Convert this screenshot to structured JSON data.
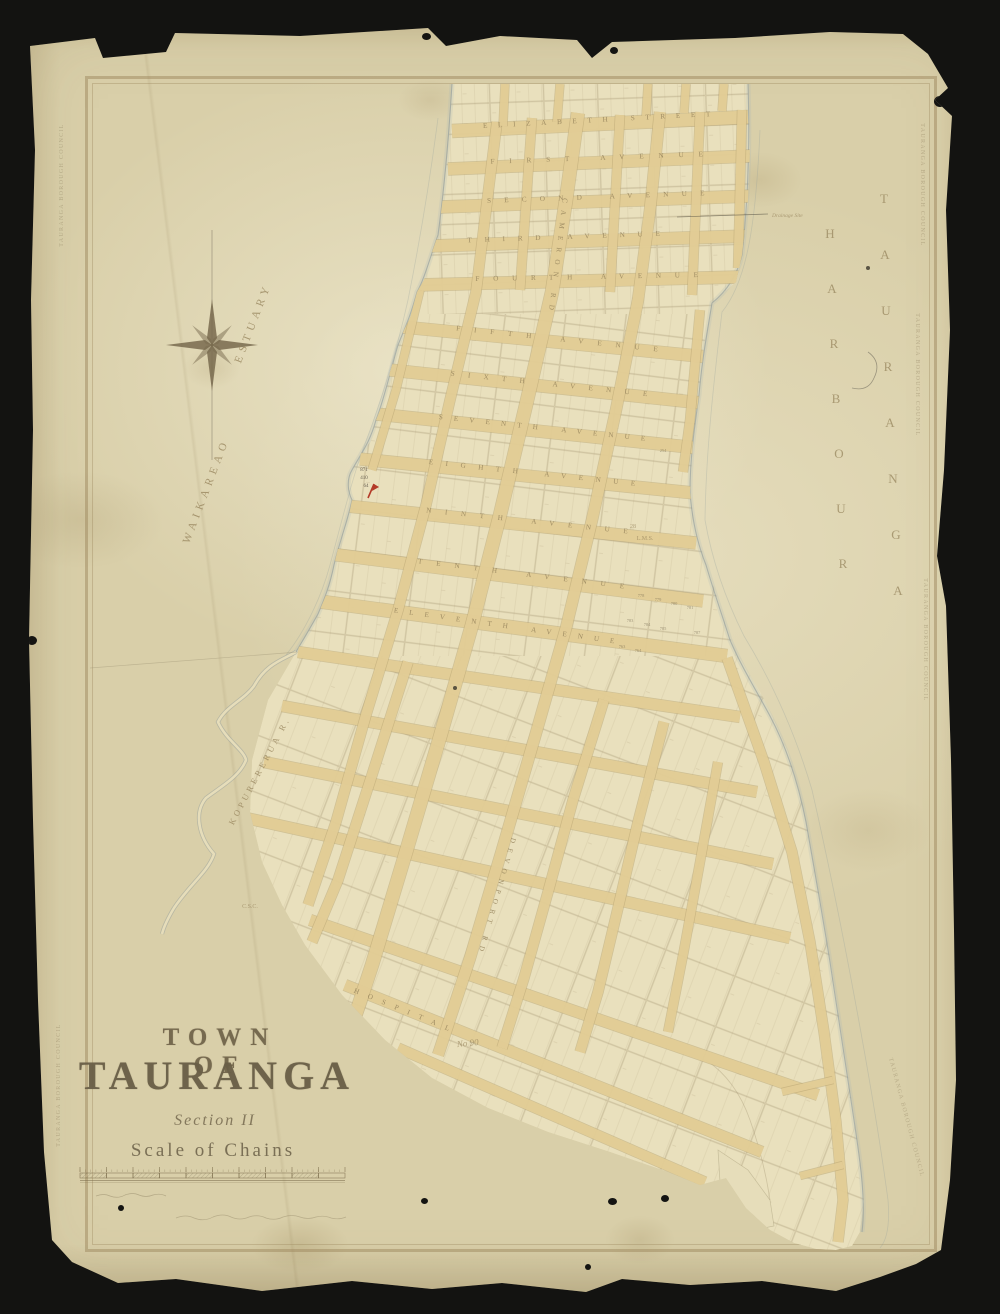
{
  "colors": {
    "backdrop": "#131311",
    "paper": "#e6ddba",
    "block_fill": "#e9e0bd",
    "street_fill": "#e3cd96",
    "street_edge": "#b39f6e",
    "parcel_line": "#93815c",
    "label_ink": "#97855d",
    "title_ink": "#6e6249",
    "shoreline": "#8d999b",
    "water_wash": "#a9b6b4",
    "red_mark": "#b33a28",
    "stamp_ink": "#7d6c4e",
    "pencil": "#6f675a"
  },
  "title_block": {
    "town_of": "TOWN OF",
    "name": "TAURANGA",
    "section": "Section II",
    "scale": "Scale of Chains"
  },
  "stamp": {
    "text": "TAURANGA BOROUGH COUNCIL",
    "positions": [
      {
        "x": 63,
        "y": 185,
        "r": -90
      },
      {
        "x": 60,
        "y": 1085,
        "r": -90
      },
      {
        "x": 921,
        "y": 185,
        "r": 90
      },
      {
        "x": 916,
        "y": 375,
        "r": 90
      },
      {
        "x": 924,
        "y": 640,
        "r": 90
      },
      {
        "x": 905,
        "y": 1118,
        "r": 75
      }
    ]
  },
  "map": {
    "water_labels": {
      "estuary_w1": {
        "t": "WAIKAREAO",
        "x": 209,
        "y": 492,
        "r": -69
      },
      "estuary_w2": {
        "t": "ESTUARY",
        "x": 256,
        "y": 324,
        "r": -69
      },
      "river": {
        "t": "KOPURERERUA R.",
        "x": 262,
        "y": 772,
        "r": -62
      },
      "harbour_w1": {
        "t": "TAURANGA",
        "x": 884,
        "y0": 203,
        "dy": 56,
        "dx": [
          0,
          1,
          2,
          4,
          6,
          9,
          12,
          14
        ]
      },
      "harbour_w2": {
        "t": "HARBOUR",
        "x": 830,
        "y0": 238,
        "dy": 55,
        "dx": [
          0,
          2,
          4,
          6,
          9,
          11,
          13
        ]
      }
    },
    "annotations": [
      {
        "t": "Drainage Site",
        "x": 772,
        "y": 217,
        "s": 5.5,
        "r": 0,
        "script": true,
        "anchor": "start"
      },
      {
        "t": "L.M.S.",
        "x": 645,
        "y": 540,
        "s": 6,
        "r": 0
      },
      {
        "t": "28",
        "x": 633,
        "y": 528,
        "s": 6,
        "r": 0
      },
      {
        "t": "C.S.C.",
        "x": 250,
        "y": 908,
        "s": 6,
        "r": 0
      },
      {
        "t": "No 90",
        "x": 468,
        "y": 1046,
        "s": 9,
        "r": -6,
        "script": true
      },
      {
        "t": "871",
        "x": 364,
        "y": 471,
        "s": 5,
        "r": 0,
        "dark": true
      },
      {
        "t": "410",
        "x": 364,
        "y": 479,
        "s": 5,
        "r": 0,
        "dark": true
      },
      {
        "t": "64",
        "x": 366,
        "y": 487,
        "s": 5,
        "r": 0,
        "dark": true
      }
    ],
    "lot_numbers": [
      [
        "254",
        663,
        452
      ],
      [
        "778",
        641,
        597
      ],
      [
        "779",
        658,
        601
      ],
      [
        "780",
        674,
        605
      ],
      [
        "781",
        690,
        609
      ],
      [
        "783",
        630,
        622
      ],
      [
        "784",
        647,
        626
      ],
      [
        "785",
        663,
        630
      ],
      [
        "787",
        697,
        634
      ],
      [
        "763",
        622,
        648
      ],
      [
        "764",
        638,
        652
      ]
    ],
    "streets": [
      {
        "n": "elizabeth-street",
        "label": "ELIZABETH STREET",
        "pts": [
          [
            452,
            131
          ],
          [
            748,
            117
          ]
        ],
        "w": 13,
        "lp": [
          598,
          122
        ],
        "lr": -3,
        "ll": 230
      },
      {
        "n": "first-avenue",
        "label": "FIRST AVENUE",
        "pts": [
          [
            448,
            169
          ],
          [
            750,
            156
          ]
        ],
        "w": 12,
        "lp": [
          598,
          160
        ],
        "lr": -2,
        "ll": 215
      },
      {
        "n": "second-avenue",
        "label": "SECOND AVENUE",
        "pts": [
          [
            440,
            207
          ],
          [
            752,
            196
          ]
        ],
        "w": 12,
        "lp": [
          597,
          199
        ],
        "lr": -2,
        "ll": 220
      },
      {
        "n": "third-avenue",
        "label": "THIRD AVENUE",
        "pts": [
          [
            430,
            246
          ],
          [
            748,
            236
          ]
        ],
        "w": 12,
        "lp": [
          565,
          239
        ],
        "lr": -2,
        "ll": 195
      },
      {
        "n": "fourth-avenue",
        "label": "FOURTH AVENUE",
        "pts": [
          [
            417,
            285
          ],
          [
            740,
            277
          ]
        ],
        "w": 12,
        "lp": [
          588,
          279
        ],
        "lr": -1,
        "ll": 225
      },
      {
        "n": "fifth-avenue",
        "label": "FIFTH AVENUE",
        "pts": [
          [
            403,
            327
          ],
          [
            708,
            357
          ]
        ],
        "w": 12,
        "lp": [
          558,
          341
        ],
        "lr": 6,
        "ll": 205
      },
      {
        "n": "sixth-avenue",
        "label": "SIXTH AVENUE",
        "pts": [
          [
            390,
            370
          ],
          [
            702,
            403
          ]
        ],
        "w": 12,
        "lp": [
          550,
          386
        ],
        "lr": 6,
        "ll": 200
      },
      {
        "n": "seventh-avenue",
        "label": "SEVENTH AVENUE",
        "pts": [
          [
            376,
            414
          ],
          [
            698,
            448
          ]
        ],
        "w": 12,
        "lp": [
          543,
          430
        ],
        "lr": 6,
        "ll": 210
      },
      {
        "n": "eighth-avenue",
        "label": "EIGHTH AVENUE",
        "pts": [
          [
            360,
            459
          ],
          [
            694,
            493
          ]
        ],
        "w": 12,
        "lp": [
          533,
          475
        ],
        "lr": 6,
        "ll": 210
      },
      {
        "n": "ninth-avenue",
        "label": "NINTH AVENUE",
        "pts": [
          [
            347,
            506
          ],
          [
            696,
            543
          ]
        ],
        "w": 12,
        "lp": [
          528,
          523
        ],
        "lr": 6,
        "ll": 205
      },
      {
        "n": "tenth-avenue",
        "label": "TENTH AVENUE",
        "pts": [
          [
            330,
            554
          ],
          [
            703,
            601
          ]
        ],
        "w": 12,
        "lp": [
          522,
          576
        ],
        "lr": 7,
        "ll": 210
      },
      {
        "n": "eleventh-avenue",
        "label": "ELEVENTH AVENUE",
        "pts": [
          [
            316,
            601
          ],
          [
            727,
            656
          ]
        ],
        "w": 13,
        "lp": [
          505,
          628
        ],
        "lr": 8,
        "ll": 225
      },
      {
        "n": "twelfth-avenue",
        "label": "",
        "pts": [
          [
            298,
            652
          ],
          [
            740,
            717
          ]
        ],
        "w": 11
      },
      {
        "n": "thirteenth-avenue",
        "label": "",
        "pts": [
          [
            282,
            706
          ],
          [
            757,
            792
          ]
        ],
        "w": 11
      },
      {
        "n": "fourteenth-avenue",
        "label": "",
        "pts": [
          [
            264,
            762
          ],
          [
            773,
            864
          ]
        ],
        "w": 11
      },
      {
        "n": "fifteenth-avenue",
        "label": "",
        "pts": [
          [
            246,
            818
          ],
          [
            790,
            938
          ]
        ],
        "w": 11
      },
      {
        "n": "sixteenth-avenue",
        "label": "",
        "pts": [
          [
            310,
            920
          ],
          [
            818,
            1095
          ]
        ],
        "w": 11
      },
      {
        "n": "hospital-street",
        "label": "HOSPITAL",
        "pts": [
          [
            345,
            985
          ],
          [
            762,
            1152
          ]
        ],
        "w": 11,
        "lp": [
          402,
          1012
        ],
        "lr": 22,
        "ll": 105
      },
      {
        "n": "lower-street",
        "label": "",
        "pts": [
          [
            398,
            1048
          ],
          [
            705,
            1182
          ]
        ],
        "w": 10
      },
      {
        "n": "cameron-road",
        "label": "CAMERON RD",
        "pts": [
          [
            578,
            113
          ],
          [
            566,
            200
          ],
          [
            552,
            292
          ],
          [
            526,
            405
          ],
          [
            500,
            515
          ],
          [
            472,
            625
          ],
          [
            440,
            737
          ],
          [
            406,
            852
          ],
          [
            372,
            965
          ],
          [
            338,
            1068
          ]
        ],
        "w": 13,
        "lp": [
          556,
          255
        ],
        "lr": 97,
        "ll": 115
      },
      {
        "n": "devonport-road",
        "label": "DEVONPORT RD",
        "pts": [
          [
            660,
            112
          ],
          [
            650,
            210
          ],
          [
            638,
            300
          ],
          [
            616,
            410
          ],
          [
            592,
            520
          ],
          [
            566,
            628
          ],
          [
            534,
            740
          ],
          [
            502,
            850
          ],
          [
            470,
            958
          ],
          [
            438,
            1055
          ]
        ],
        "w": 11,
        "lp": [
          495,
          895
        ],
        "lr": 106,
        "ll": 120
      },
      {
        "n": "west-road",
        "label": "",
        "pts": [
          [
            497,
            122
          ],
          [
            486,
            210
          ],
          [
            476,
            292
          ],
          [
            450,
            400
          ],
          [
            426,
            505
          ],
          [
            398,
            610
          ],
          [
            366,
            715
          ],
          [
            336,
            822
          ],
          [
            308,
            905
          ]
        ],
        "w": 10
      },
      {
        "n": "shore-road",
        "label": "",
        "pts": [
          [
            420,
            290
          ],
          [
            396,
            390
          ],
          [
            372,
            470
          ]
        ],
        "w": 8
      },
      {
        "n": "tail-road",
        "label": "",
        "pts": [
          [
            727,
            658
          ],
          [
            764,
            762
          ],
          [
            792,
            852
          ],
          [
            810,
            942
          ],
          [
            824,
            1032
          ],
          [
            836,
            1122
          ],
          [
            843,
            1200
          ],
          [
            838,
            1242
          ]
        ],
        "w": 10
      },
      {
        "n": "mid-road-1",
        "label": "",
        "pts": [
          [
            604,
            700
          ],
          [
            573,
            800
          ],
          [
            548,
            892
          ],
          [
            524,
            978
          ],
          [
            502,
            1048
          ]
        ],
        "w": 10
      },
      {
        "n": "mid-road-2",
        "label": "",
        "pts": [
          [
            664,
            722
          ],
          [
            638,
            822
          ],
          [
            618,
            908
          ],
          [
            598,
            992
          ],
          [
            580,
            1052
          ]
        ],
        "w": 10
      },
      {
        "n": "mid-road-3",
        "label": "",
        "pts": [
          [
            718,
            762
          ],
          [
            700,
            862
          ],
          [
            684,
            950
          ],
          [
            668,
            1032
          ]
        ],
        "w": 9
      },
      {
        "n": "west-lower-road",
        "label": "",
        "pts": [
          [
            408,
            662
          ],
          [
            372,
            775
          ],
          [
            338,
            880
          ],
          [
            312,
            942
          ]
        ],
        "w": 10
      },
      {
        "n": "east-mid-road",
        "label": "",
        "pts": [
          [
            700,
            310
          ],
          [
            690,
            420
          ],
          [
            683,
            472
          ]
        ],
        "w": 9
      },
      {
        "n": "neck-cross-1",
        "label": "",
        "pts": [
          [
            532,
            118
          ],
          [
            520,
            290
          ]
        ],
        "w": 9
      },
      {
        "n": "neck-cross-2",
        "label": "",
        "pts": [
          [
            620,
            115
          ],
          [
            610,
            292
          ]
        ],
        "w": 9
      },
      {
        "n": "neck-cross-3",
        "label": "",
        "pts": [
          [
            700,
            112
          ],
          [
            692,
            295
          ]
        ],
        "w": 9
      },
      {
        "n": "neck-cross-4",
        "label": "",
        "pts": [
          [
            742,
            110
          ],
          [
            738,
            268
          ]
        ],
        "w": 9
      },
      {
        "n": "neck-stub-1",
        "label": "",
        "pts": [
          [
            505,
            84
          ],
          [
            503,
            126
          ]
        ],
        "w": 8
      },
      {
        "n": "neck-stub-2",
        "label": "",
        "pts": [
          [
            560,
            84
          ],
          [
            557,
            122
          ]
        ],
        "w": 8
      },
      {
        "n": "neck-stub-3",
        "label": "",
        "pts": [
          [
            648,
            84
          ],
          [
            646,
            116
          ]
        ],
        "w": 8
      },
      {
        "n": "neck-stub-4",
        "label": "",
        "pts": [
          [
            686,
            84
          ],
          [
            684,
            113
          ]
        ],
        "w": 8
      },
      {
        "n": "neck-stub-5",
        "label": "",
        "pts": [
          [
            724,
            84
          ],
          [
            722,
            111
          ]
        ],
        "w": 8
      },
      {
        "n": "tail-cross-1",
        "label": "",
        "pts": [
          [
            782,
            1092
          ],
          [
            833,
            1080
          ]
        ],
        "w": 7
      },
      {
        "n": "tail-cross-2",
        "label": "",
        "pts": [
          [
            800,
            1176
          ],
          [
            843,
            1165
          ]
        ],
        "w": 7
      }
    ],
    "paths": {
      "peninsula": "M452,84 L748,84 L750,150 L748,200 L742,255 L736,282 L712,303 L704,345 L699,395 L693,440 L690,492 L694,522 L701,548 L709,572 L718,600 L726,625 L734,648 L748,672 L762,695 L774,720 L788,752 L799,790 L807,826 L815,872 L823,916 L831,964 L839,1016 L847,1070 L855,1122 L860,1162 L864,1202 L860,1232 L852,1246 L836,1250 L816,1249 L794,1243 L770,1230 L746,1208 L726,1178 L700,1185 L668,1172 L610,1152 L548,1132 L488,1108 L432,1078 L385,1040 L342,995 L305,945 L282,905 L262,862 L250,812 L252,760 L268,700 L296,652 L308,632 L318,614 L324,600 L330,585 L334,565 L340,540 L348,520 L352,500 L348,492 L346,480 L352,470 L362,452 L370,442 L376,420 L384,400 L390,372 L398,345 L404,330 L410,318 L417,292 L424,280 L430,258 L438,235 L442,205 L448,150 Z",
      "west_shore": "M452,84 C448,150 442,205 438,235 C430,258 424,280 417,292 C410,318 404,330 398,345 C390,372 384,400 376,420 C370,442 362,452 352,470 C346,480 348,492 352,500 C348,520 340,540 334,565 C330,585 324,600 318,614 C308,632 300,645 296,652",
      "west_shore_outer": "M438,118 C430,180 420,240 408,300 C398,345 382,400 362,452 C352,480 342,520 330,565 C322,595 306,630 286,655",
      "east_shore": "M748,84 C750,150 748,200 742,255 C736,280 722,295 712,303 C706,340 702,360 699,395 C694,430 690,460 690,492 C692,520 698,545 706,565 C714,592 722,615 730,640 C742,668 756,690 770,716 C786,746 798,782 806,822 C814,868 822,912 830,962 C838,1015 846,1068 854,1120 C860,1160 866,1200 862,1232",
      "east_shore_outer": "M760,130 C756,220 748,280 722,312 C714,380 706,450 705,520 C712,560 726,600 744,636 C766,672 792,722 812,790 C828,860 842,930 855,1000 C868,1070 880,1140 888,1200 C890,1225 887,1240 880,1248",
      "river": "M296,652 C282,660 266,664 254,686 C244,700 226,706 218,722 C226,740 244,750 246,760 C240,776 222,786 206,798 C194,812 198,836 214,854 C208,872 190,884 174,908 C168,918 164,926 162,934",
      "reserve": "M718,1150 L748,1170 L770,1200 L774,1226 L754,1230 L734,1212 L720,1182 Z",
      "hill": "M706,1060 q30,20 44,60 q14,40 20,80",
      "survey_line": "M90,668 L298,652",
      "scribble": "M868,352 q14,10 6,26 q-6,14 -22,10",
      "drainage_line": "M677,217 L768,214",
      "fineprint1": "M96,1196 q8,-3 14,0 q8,3 15,-1 q8,-3 14,0 q7,3 14,0 q7,-2 13,1",
      "fineprint2": "M176,1218 q10,-4 18,0 q10,4 19,-1 q10,-4 18,0 q9,4 18,0 q9,-3 17,1 q9,3 17,-1 q9,-3 17,0 q8,3 16,0 q8,-2 15,1 q8,2 15,-1"
    },
    "compass": {
      "x": 212,
      "y": 345
    },
    "scalebar": {
      "x": 80,
      "y": 1167,
      "len": 265,
      "cells": 10
    },
    "red_mark": {
      "x": 368,
      "y": 498
    },
    "ink_spots": [
      [
        868,
        268,
        4
      ],
      [
        455,
        688,
        4
      ]
    ]
  }
}
